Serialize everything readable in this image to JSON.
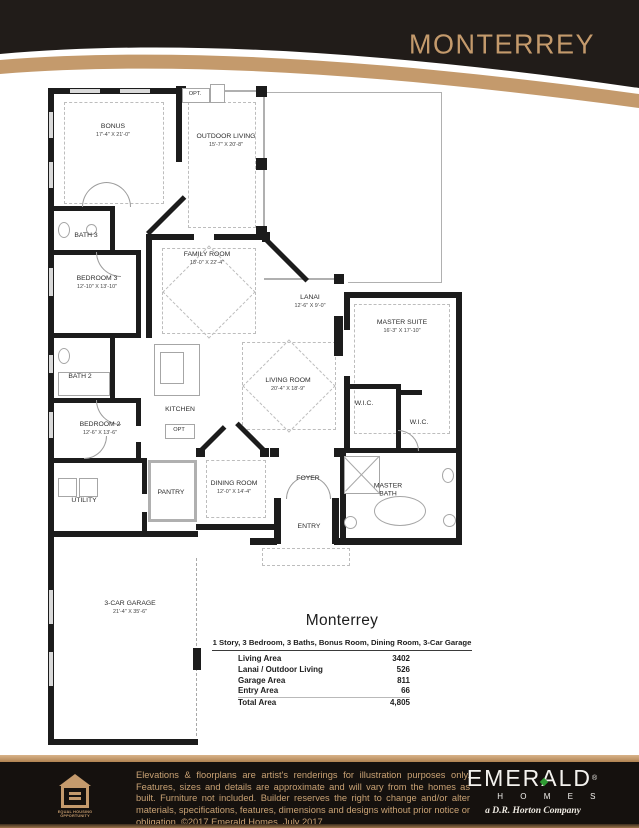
{
  "header": {
    "title": "MONTERREY"
  },
  "plan": {
    "rooms": {
      "bonus": {
        "name": "BONUS",
        "dims": "17'-4\" X 21'-0\""
      },
      "outdoor": {
        "name": "OUTDOOR LIVING",
        "dims": "15'-7\" X 20'-8\""
      },
      "opt_top": {
        "name": "OPT."
      },
      "bath3": {
        "name": "BATH 3"
      },
      "family": {
        "name": "FAMILY ROOM",
        "dims": "18'-0\" X 22'-4\""
      },
      "bedroom3": {
        "name": "BEDROOM 3",
        "dims": "12'-10\" X 13'-10\""
      },
      "lanai": {
        "name": "LANAI",
        "dims": "12'-6\" X 9'-0\""
      },
      "master_suite": {
        "name": "MASTER SUITE",
        "dims": "16'-3\" X 17'-10\""
      },
      "bath2": {
        "name": "BATH 2"
      },
      "living": {
        "name": "LIVING ROOM",
        "dims": "20'-4\" X 18'-9\""
      },
      "kitchen": {
        "name": "KITCHEN"
      },
      "opt_kitchen": {
        "name": "OPT"
      },
      "wic1": {
        "name": "W.I.C."
      },
      "wic2": {
        "name": "W.I.C."
      },
      "bedroom2": {
        "name": "BEDROOM 2",
        "dims": "12'-6\" X 13'-6\""
      },
      "utility": {
        "name": "UTILITY"
      },
      "pantry": {
        "name": "PANTRY"
      },
      "dining": {
        "name": "DINING ROOM",
        "dims": "12'-0\" X 14'-4\""
      },
      "foyer": {
        "name": "FOYER"
      },
      "entry": {
        "name": "ENTRY"
      },
      "master_bath": {
        "name": "MASTER BATH"
      },
      "garage": {
        "name": "3-CAR GARAGE",
        "dims": "21'-4\" X 35'-6\""
      }
    }
  },
  "specs": {
    "title": "Monterrey",
    "subtitle": "1 Story, 3 Bedroom, 3 Baths, Bonus Room, Dining Room, 3-Car Garage",
    "rows": [
      {
        "label": "Living Area",
        "value": "3402"
      },
      {
        "label": "Lanai / Outdoor Living",
        "value": "526"
      },
      {
        "label": "Garage Area",
        "value": "811"
      },
      {
        "label": "Entry Area",
        "value": "66"
      },
      {
        "label": "Total Area",
        "value": "4,805"
      }
    ]
  },
  "footer": {
    "disclaimer": "Elevations & floorplans are artist's renderings for illustration purposes only. Features, sizes and details are approximate and will vary from the homes as built. Furniture not included. Builder reserves the right to change and/or alter materials, specifications, features, dimensions and designs without prior notice or obligation. ©2017 Emerald Homes,  July 2017",
    "eho_label": "EQUAL HOUSING OPPORTUNITY",
    "brand": {
      "name": "EMERALD",
      "reg": "®",
      "homes": "H O M E S",
      "tagline": "a D.R. Horton Company"
    }
  },
  "colors": {
    "gold": "#C49A6C",
    "header_black": "#211c19",
    "footer_black": "#15110e",
    "diamond_green": "#2f9b33"
  }
}
